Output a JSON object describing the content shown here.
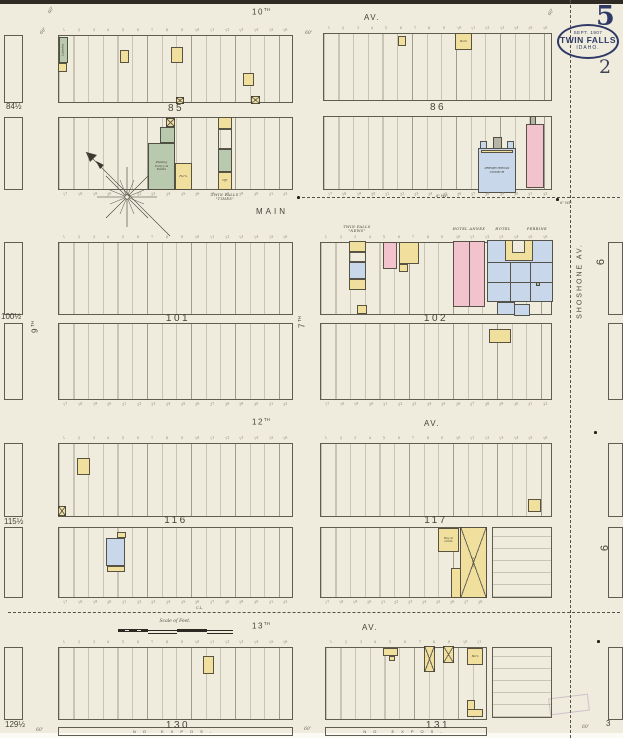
{
  "page": {
    "sheet_number": "5",
    "secondary_number": "2",
    "corner_number": "3",
    "stamp": {
      "date": "SEPT. 1907",
      "city": "TWIN FALLS",
      "state": "IDAHO."
    }
  },
  "streets": {
    "tenth": {
      "n": "10",
      "s": "TH"
    },
    "tenth_av": "AV.",
    "main": "MAIN",
    "twelfth": {
      "n": "12",
      "s": "TH"
    },
    "twelfth_av": "AV.",
    "thirteenth": {
      "n": "13",
      "s": "TH"
    },
    "thirteenth_av": "AV.",
    "seventh": {
      "n": "7",
      "s": "TH"
    },
    "ninth": {
      "n": "9",
      "s": "TH"
    },
    "shoshone": "SHOSHONE AV."
  },
  "scale": {
    "label": "Scale of Feet."
  },
  "notes": {
    "no_expos": "NO EXPOS-",
    "city_limits": "C.L.",
    "water_pipe": "6\" W.P."
  },
  "lots": {
    "north": [
      "1",
      "2",
      "3",
      "4",
      "5",
      "6",
      "7",
      "8",
      "9",
      "10",
      "11",
      "12",
      "13",
      "14",
      "15",
      "16"
    ],
    "south": [
      "17",
      "18",
      "19",
      "20",
      "21",
      "22",
      "23",
      "24",
      "25",
      "26",
      "27",
      "28",
      "29",
      "30",
      "31",
      "32"
    ]
  },
  "map": {
    "strips": [
      {
        "x": 58,
        "y": 35,
        "w": 235,
        "h": 68
      },
      {
        "x": 58,
        "y": 117,
        "w": 235,
        "h": 73
      },
      {
        "x": 323,
        "y": 33,
        "w": 229,
        "h": 68
      },
      {
        "x": 323,
        "y": 116,
        "w": 229,
        "h": 74
      },
      {
        "x": 58,
        "y": 242,
        "w": 235,
        "h": 73
      },
      {
        "x": 58,
        "y": 323,
        "w": 235,
        "h": 77
      },
      {
        "x": 320,
        "y": 242,
        "w": 232,
        "h": 73
      },
      {
        "x": 320,
        "y": 323,
        "w": 232,
        "h": 77
      },
      {
        "x": 58,
        "y": 443,
        "w": 235,
        "h": 74
      },
      {
        "x": 58,
        "y": 527,
        "w": 235,
        "h": 71
      },
      {
        "x": 320,
        "y": 443,
        "w": 232,
        "h": 74
      },
      {
        "x": 320,
        "y": 527,
        "w": 167,
        "h": 71
      },
      {
        "x": 492,
        "y": 527,
        "w": 60,
        "h": 71,
        "h2": 1
      },
      {
        "x": 58,
        "y": 647,
        "w": 235,
        "h": 73
      },
      {
        "x": 325,
        "y": 647,
        "w": 162,
        "h": 73
      },
      {
        "x": 492,
        "y": 647,
        "w": 60,
        "h": 71,
        "h2": 1
      },
      {
        "x": 4,
        "y": 35,
        "w": 19,
        "h": 68,
        "plain": 1
      },
      {
        "x": 4,
        "y": 117,
        "w": 19,
        "h": 73,
        "plain": 1
      },
      {
        "x": 4,
        "y": 242,
        "w": 19,
        "h": 73,
        "plain": 1
      },
      {
        "x": 4,
        "y": 323,
        "w": 19,
        "h": 77,
        "plain": 1
      },
      {
        "x": 4,
        "y": 443,
        "w": 19,
        "h": 74,
        "plain": 1
      },
      {
        "x": 4,
        "y": 527,
        "w": 19,
        "h": 71,
        "plain": 1
      },
      {
        "x": 4,
        "y": 647,
        "w": 19,
        "h": 73,
        "plain": 1
      },
      {
        "x": 608,
        "y": 242,
        "w": 15,
        "h": 73,
        "plain": 1
      },
      {
        "x": 608,
        "y": 323,
        "w": 15,
        "h": 77,
        "plain": 1
      },
      {
        "x": 608,
        "y": 443,
        "w": 15,
        "h": 74,
        "plain": 1
      },
      {
        "x": 608,
        "y": 527,
        "w": 15,
        "h": 71,
        "plain": 1
      },
      {
        "x": 608,
        "y": 647,
        "w": 15,
        "h": 73,
        "plain": 1
      }
    ],
    "block_labels": [
      {
        "t": "85",
        "x": 176,
        "y": 103
      },
      {
        "t": "86",
        "x": 438,
        "y": 102
      },
      {
        "t": "101",
        "x": 178,
        "y": 313
      },
      {
        "t": "102",
        "x": 436,
        "y": 313
      },
      {
        "t": "116",
        "x": 176,
        "y": 515
      },
      {
        "t": "117",
        "x": 436,
        "y": 515
      },
      {
        "t": "130",
        "x": 178,
        "y": 720
      },
      {
        "t": "131",
        "x": 438,
        "y": 720
      }
    ],
    "half_labels": [
      {
        "t": "84½",
        "x": 6,
        "y": 102
      },
      {
        "t": "100½",
        "x": 1,
        "y": 312
      },
      {
        "t": "115½",
        "x": 4,
        "y": 517
      },
      {
        "t": "129½",
        "x": 5,
        "y": 720
      }
    ],
    "six_labels": [
      {
        "t": "6",
        "x": 598,
        "y": 256
      },
      {
        "t": "6",
        "x": 602,
        "y": 542
      }
    ],
    "buildings": [
      {
        "x": 59,
        "y": 37,
        "w": 9,
        "h": 26,
        "c": "g",
        "l": "Laundry",
        "r": -90,
        "fs": 2.8
      },
      {
        "x": 58,
        "y": 63,
        "w": 9,
        "h": 9,
        "c": "y"
      },
      {
        "x": 120,
        "y": 50,
        "w": 9,
        "h": 13,
        "c": "y"
      },
      {
        "x": 171,
        "y": 47,
        "w": 12,
        "h": 16,
        "c": "y"
      },
      {
        "x": 243,
        "y": 73,
        "w": 11,
        "h": 13,
        "c": "y"
      },
      {
        "x": 176,
        "y": 97,
        "w": 8,
        "h": 7,
        "c": "y",
        "xm": 1
      },
      {
        "x": 251,
        "y": 96,
        "w": 9,
        "h": 8,
        "c": "y",
        "xm": 1
      },
      {
        "x": 166,
        "y": 118,
        "w": 9,
        "h": 9,
        "c": "y",
        "xm": 1
      },
      {
        "x": 160,
        "y": 127,
        "w": 15,
        "h": 16,
        "c": "g"
      },
      {
        "x": 148,
        "y": 143,
        "w": 27,
        "h": 47,
        "c": "g",
        "l": "Planing\nCarp'y &\nPaints",
        "fs": 3
      },
      {
        "x": 175,
        "y": 163,
        "w": 17,
        "h": 27,
        "c": "y",
        "l": "Furn.",
        "fs": 3
      },
      {
        "x": 218,
        "y": 117,
        "w": 14,
        "h": 12,
        "c": "y"
      },
      {
        "x": 218,
        "y": 129,
        "w": 14,
        "h": 20,
        "c": "n"
      },
      {
        "x": 218,
        "y": 149,
        "w": 14,
        "h": 23,
        "c": "g"
      },
      {
        "x": 218,
        "y": 172,
        "w": 14,
        "h": 18,
        "c": "y",
        "l": "Off.",
        "fs": 3
      },
      {
        "x": 398,
        "y": 36,
        "w": 8,
        "h": 10,
        "c": "y"
      },
      {
        "x": 455,
        "y": 33,
        "w": 17,
        "h": 17,
        "c": "y",
        "l": "Barn",
        "fs": 2.8
      },
      {
        "x": 480,
        "y": 141,
        "w": 7,
        "h": 9,
        "c": "b"
      },
      {
        "x": 493,
        "y": 137,
        "w": 9,
        "h": 13,
        "c": "gr"
      },
      {
        "x": 507,
        "y": 141,
        "w": 7,
        "h": 9,
        "c": "b"
      },
      {
        "x": 478,
        "y": 148,
        "w": 38,
        "h": 45,
        "c": "b",
        "l": "PRESBYTERIAN\nCHURCH",
        "fs": 3
      },
      {
        "x": 481,
        "y": 150,
        "w": 32,
        "h": 2.5,
        "c": "y"
      },
      {
        "x": 526,
        "y": 124,
        "w": 18,
        "h": 64,
        "c": "p"
      },
      {
        "x": 530,
        "y": 116,
        "w": 6,
        "h": 9,
        "c": "gr"
      },
      {
        "x": 349,
        "y": 241,
        "w": 17,
        "h": 11,
        "c": "y"
      },
      {
        "x": 349,
        "y": 252,
        "w": 17,
        "h": 10,
        "c": "n"
      },
      {
        "x": 349,
        "y": 262,
        "w": 17,
        "h": 17,
        "c": "b"
      },
      {
        "x": 349,
        "y": 279,
        "w": 17,
        "h": 11,
        "c": "y"
      },
      {
        "x": 383,
        "y": 242,
        "w": 14,
        "h": 27,
        "c": "p"
      },
      {
        "x": 399,
        "y": 242,
        "w": 20,
        "h": 22,
        "c": "y"
      },
      {
        "x": 399,
        "y": 264,
        "w": 9,
        "h": 8,
        "c": "y"
      },
      {
        "x": 453,
        "y": 241,
        "w": 32,
        "h": 66,
        "c": "p"
      },
      {
        "x": 469,
        "y": 241,
        "w": 0.8,
        "h": 66,
        "c": "ln"
      },
      {
        "x": 487,
        "y": 240,
        "w": 66,
        "h": 62,
        "c": "b"
      },
      {
        "x": 487,
        "y": 262,
        "w": 66,
        "h": 0.8,
        "c": "ln"
      },
      {
        "x": 487,
        "y": 282,
        "w": 66,
        "h": 0.8,
        "c": "ln"
      },
      {
        "x": 510,
        "y": 262,
        "w": 0.8,
        "h": 40,
        "c": "ln"
      },
      {
        "x": 530,
        "y": 262,
        "w": 0.8,
        "h": 40,
        "c": "ln"
      },
      {
        "x": 505,
        "y": 240,
        "w": 28,
        "h": 21,
        "c": "y"
      },
      {
        "x": 512,
        "y": 240,
        "w": 13,
        "h": 13,
        "c": "w"
      },
      {
        "x": 497,
        "y": 302,
        "w": 18,
        "h": 13,
        "c": "b"
      },
      {
        "x": 514,
        "y": 304,
        "w": 16,
        "h": 12,
        "c": "b"
      },
      {
        "x": 536,
        "y": 282,
        "w": 4,
        "h": 4,
        "c": "gr"
      },
      {
        "x": 357,
        "y": 305,
        "w": 10,
        "h": 9,
        "c": "y"
      },
      {
        "x": 489,
        "y": 329,
        "w": 22,
        "h": 14,
        "c": "y"
      },
      {
        "x": 77,
        "y": 458,
        "w": 13,
        "h": 17,
        "c": "y"
      },
      {
        "x": 58,
        "y": 506,
        "w": 8,
        "h": 10,
        "c": "y",
        "xm": 1
      },
      {
        "x": 117,
        "y": 532,
        "w": 9,
        "h": 6,
        "c": "y"
      },
      {
        "x": 106,
        "y": 538,
        "w": 19,
        "h": 28,
        "c": "b"
      },
      {
        "x": 107,
        "y": 566,
        "w": 18,
        "h": 6,
        "c": "y"
      },
      {
        "x": 528,
        "y": 499,
        "w": 13,
        "h": 13,
        "c": "y"
      },
      {
        "x": 438,
        "y": 528,
        "w": 21,
        "h": 24,
        "c": "y",
        "l": "Hay &\nGrain",
        "fs": 2.8
      },
      {
        "x": 460,
        "y": 527,
        "w": 27,
        "h": 71,
        "c": "y",
        "xm": 1,
        "l": "Livery",
        "r": -90,
        "fs": 3
      },
      {
        "x": 451,
        "y": 568,
        "w": 10,
        "h": 30,
        "c": "y"
      },
      {
        "x": 203,
        "y": 656,
        "w": 11,
        "h": 18,
        "c": "y"
      },
      {
        "x": 383,
        "y": 648,
        "w": 15,
        "h": 8,
        "c": "y"
      },
      {
        "x": 389,
        "y": 656,
        "w": 6,
        "h": 5,
        "c": "y"
      },
      {
        "x": 424,
        "y": 646,
        "w": 11,
        "h": 26,
        "c": "y",
        "xm": 1
      },
      {
        "x": 443,
        "y": 646,
        "w": 11,
        "h": 17,
        "c": "y",
        "xm": 1
      },
      {
        "x": 467,
        "y": 648,
        "w": 16,
        "h": 17,
        "c": "y",
        "l": "Barn",
        "fs": 2.8
      },
      {
        "x": 467,
        "y": 700,
        "w": 8,
        "h": 17,
        "c": "y"
      },
      {
        "x": 467,
        "y": 709,
        "w": 16,
        "h": 8,
        "c": "y"
      }
    ],
    "map_labels": [
      {
        "t": "TWIN FALLS\n\"TIMES\"",
        "x": 225,
        "y": 193
      },
      {
        "t": "TWIN FALLS\n\"NEWS\"",
        "x": 357,
        "y": 225
      },
      {
        "t": "HOTEL ANNEX",
        "x": 469,
        "y": 227
      },
      {
        "t": "HOTEL",
        "x": 503,
        "y": 227
      },
      {
        "t": "PERRINE",
        "x": 537,
        "y": 227
      }
    ],
    "dims": [
      {
        "t": "60'",
        "x": 48,
        "y": 8,
        "r": -55
      },
      {
        "t": "60'",
        "x": 40,
        "y": 29,
        "r": -50
      },
      {
        "t": "60'",
        "x": 305,
        "y": 31,
        "r": 0
      },
      {
        "t": "60'",
        "x": 548,
        "y": 10,
        "r": -55
      },
      {
        "t": "60'",
        "x": 36,
        "y": 728,
        "r": 0
      },
      {
        "t": "60'",
        "x": 304,
        "y": 727,
        "r": 0
      },
      {
        "t": "60'",
        "x": 582,
        "y": 725,
        "r": 0
      }
    ],
    "notes": [
      {
        "t": "6\" W.P.",
        "x": 436,
        "y": 194
      },
      {
        "t": "6\" W.P.",
        "x": 560,
        "y": 201
      },
      {
        "t": "C.L.",
        "x": 196,
        "y": 606
      }
    ],
    "dots": [
      {
        "x": 297,
        "y": 196
      },
      {
        "x": 556,
        "y": 198
      },
      {
        "x": 594,
        "y": 431
      },
      {
        "x": 597,
        "y": 640
      }
    ],
    "lot_rows": [
      {
        "x": 58,
        "y": 28,
        "w": 235,
        "set": "north"
      },
      {
        "x": 323,
        "y": 26,
        "w": 229,
        "set": "north"
      },
      {
        "x": 58,
        "y": 235,
        "w": 235,
        "set": "north"
      },
      {
        "x": 320,
        "y": 235,
        "w": 232,
        "set": "north"
      },
      {
        "x": 58,
        "y": 436,
        "w": 235,
        "set": "north"
      },
      {
        "x": 320,
        "y": 436,
        "w": 232,
        "set": "north"
      },
      {
        "x": 58,
        "y": 640,
        "w": 235,
        "set": "north"
      },
      {
        "x": 325,
        "y": 640,
        "w": 162,
        "set": "north",
        "count": 11
      },
      {
        "x": 58,
        "y": 192,
        "w": 235,
        "set": "south"
      },
      {
        "x": 323,
        "y": 192,
        "w": 229,
        "set": "south"
      },
      {
        "x": 58,
        "y": 402,
        "w": 235,
        "set": "south"
      },
      {
        "x": 320,
        "y": 402,
        "w": 232,
        "set": "south"
      },
      {
        "x": 58,
        "y": 600,
        "w": 235,
        "set": "south"
      },
      {
        "x": 320,
        "y": 600,
        "w": 167,
        "set": "south",
        "count": 12
      }
    ]
  }
}
